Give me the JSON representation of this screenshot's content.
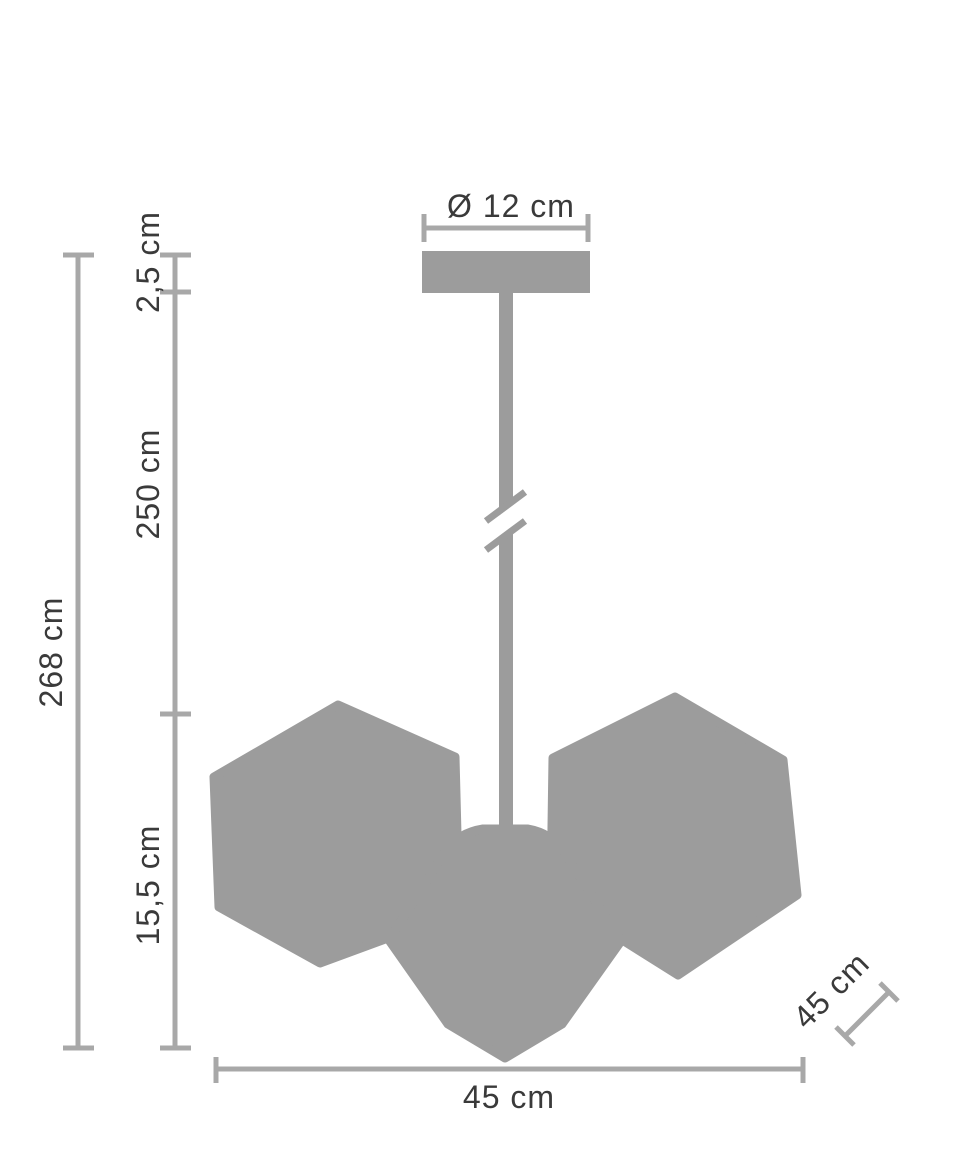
{
  "diagram": {
    "type": "pendant-lamp-dimension-drawing",
    "labels": {
      "canopy_diameter": "Ø 12 cm",
      "canopy_height": "2,5 cm",
      "suspension_length": "250 cm",
      "total_height": "268 cm",
      "shade_height": "15,5 cm",
      "width": "45 cm",
      "depth": "45 cm"
    },
    "dimensions_cm": {
      "canopy_diameter": 12,
      "canopy_height": 2.5,
      "suspension_length": 250,
      "total_height": 268,
      "shade_height": 15.5,
      "width": 45,
      "depth": 45
    },
    "colors": {
      "silhouette": "#9c9c9c",
      "dimension": "#a8a8a8",
      "text": "#3a3a3a",
      "background": "#ffffff"
    }
  }
}
